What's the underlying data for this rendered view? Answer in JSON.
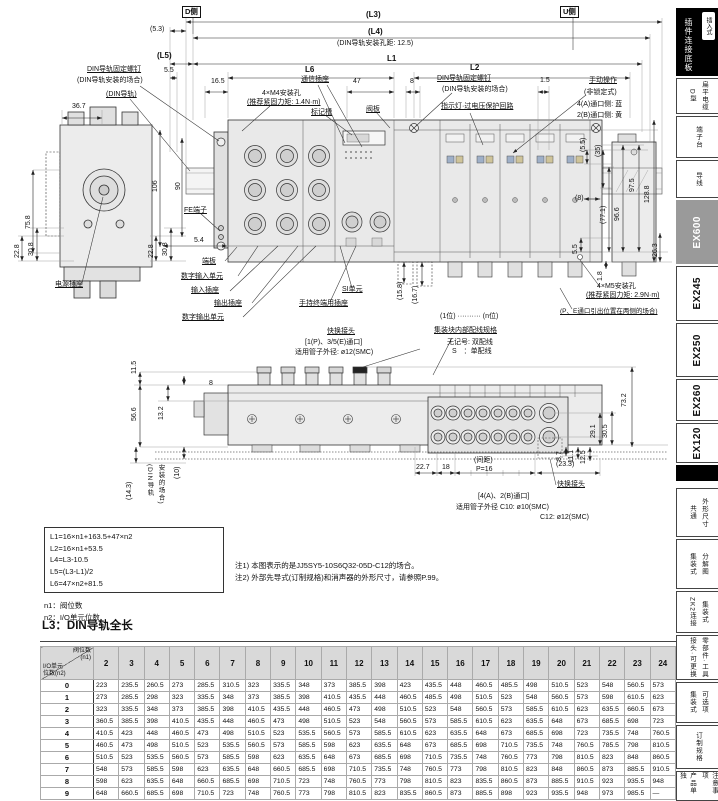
{
  "d1": {
    "side_d": "D侧",
    "side_u": "U侧",
    "l3": "(L3)",
    "dim53": "(5.3)",
    "l4": "(L4)",
    "din_pitch": "(DIN导轨安装孔距: 12.5)",
    "l5": "(L5)",
    "l1": "L1",
    "dim55": "5.5",
    "l6": "L6",
    "l2": "L2",
    "dim165": "16.5",
    "comm_socket": "通信插座",
    "dim47": "47",
    "dim8": "8",
    "dim15": "1.5",
    "m4_hole": "4×M4安装孔",
    "m4_torque": "(推荐紧固力矩: 1.4N·m)",
    "mark_slot": "标记槽",
    "din_screw": "DIN导轨固定螺钉",
    "din_screw_case": "(DIN导轨安装的场合)",
    "din_rail": "(DIN导轨)",
    "valve_plate": "阀板",
    "din_screw_r": "DIN导轨固定螺钉",
    "din_screw_r_case": "(DIN导轨安装的场合)",
    "indicator": "指示灯·过电压保护回路",
    "manual_op": "手动操作",
    "manual_type": "(非锁定式)",
    "manual_a": "4(A)通口侧: 蓝",
    "manual_b": "2(B)通口侧: 黄",
    "dim367": "36.7",
    "dim106": "106",
    "dim90": "90",
    "dim758": "75.8",
    "fe_terminal": "FE端子",
    "dim228a": "22.8",
    "dim308a": "30.8",
    "dim228b": "22.8",
    "dim308b": "30.8",
    "dim54": "5.4",
    "power_socket": "电源插座",
    "end_plate": "端板",
    "digital_in": "数字输入单元",
    "in_socket": "输入插座",
    "out_socket": "输出插座",
    "digital_out": "数字输出单元",
    "si_unit": "SI单元",
    "handheld": "手持终端用插座",
    "rdim55t": "(5.5)",
    "rdim35": "(35)",
    "rdim975": "97.5",
    "rdim1288": "128.8",
    "rdim8": "(8)",
    "rdim771": "(77.1)",
    "rdim966": "96.6",
    "rdim55b": "5.5",
    "rdim263": "26.3",
    "rdim18": "1.8",
    "dim158": "(15.8)",
    "dim167": "(16.7)",
    "m5_hole": "4×M5安装孔",
    "m5_torque": "(推荐紧固力矩: 2.9N·m)",
    "pe_note": "(P、E通口引出位置在两侧的场合)",
    "pos_range": "(1位) ·········· (n位)",
    "wiring_title": "集装块内部配线规格",
    "wiring_none": "无记号: 双配线",
    "wiring_s": "S　：单配线"
  },
  "d2": {
    "qf_top": "快换接头",
    "qf_top_ports": "[1(P)、3/5(E)通口]",
    "qf_top_tube": "适用管子外径: ø12(SMC)",
    "dim115": "11.5",
    "dim8": "8",
    "dim132": "13.2",
    "dim566": "56.6",
    "dim10": "(10)",
    "dim143": "(14.3)",
    "din_case1": "(DIN导轨",
    "din_case2": "安装的场合)",
    "dim732": "73.2",
    "dim305": "30.5",
    "dim291": "29.1",
    "dim87": "8.7",
    "dim111": "11.1",
    "dim125": "12.5",
    "dim227": "22.7",
    "dim18": "18",
    "pitch_label": "(间距)",
    "pitch_val": "P=16",
    "dim233": "(23.3)",
    "qf_bot": "快换接头",
    "qf_bot_ports": "[4(A)、2(B)通口]",
    "qf_bot_tube": "适用管子外径 C10: ø10(SMC)",
    "qf_bot_tube2": "C12: ø12(SMC)"
  },
  "formulas": [
    "L1=16×n1+163.5+47×n2",
    "L2=16×n1+53.5",
    "L4=L3-10.5",
    "L5=(L3-L1)/2",
    "L6=47×n2+81.5"
  ],
  "defs": [
    "n1：阀位数",
    "n2：I/O单元位数"
  ],
  "notes": [
    "注1) 本图表示的是JJ5SY5-10S6Q32-05D-C12的场合。",
    "注2) 外部先导式(订制规格)和消声器的外形尺寸，请参照P.99。"
  ],
  "table": {
    "title": "L3：DIN导轨全长",
    "corner_top": "阀位数",
    "corner_top2": "(n1)",
    "corner_left": "I/O单元",
    "corner_left2": "位数(n2)",
    "columns": [
      "2",
      "3",
      "4",
      "5",
      "6",
      "7",
      "8",
      "9",
      "10",
      "11",
      "12",
      "13",
      "14",
      "15",
      "16",
      "17",
      "18",
      "19",
      "20",
      "21",
      "22",
      "23",
      "24"
    ],
    "rows": [
      {
        "n2": "0",
        "values": [
          223,
          235.5,
          260.5,
          273,
          285.5,
          310.5,
          323,
          335.5,
          348,
          373,
          385.5,
          398,
          423,
          435.5,
          448,
          460.5,
          485.5,
          498,
          510.5,
          523,
          548,
          560.5,
          573
        ]
      },
      {
        "n2": "1",
        "values": [
          273,
          285.5,
          298,
          323,
          335.5,
          348,
          373,
          385.5,
          398,
          410.5,
          435.5,
          448,
          460.5,
          485.5,
          498,
          510.5,
          523,
          548,
          560.5,
          573,
          598,
          610.5,
          623
        ]
      },
      {
        "n2": "2",
        "values": [
          323,
          335.5,
          348,
          373,
          385.5,
          398,
          410.5,
          435.5,
          448,
          460.5,
          473,
          498,
          510.5,
          523,
          548,
          560.5,
          573,
          585.5,
          610.5,
          623,
          635.5,
          660.5,
          673
        ]
      },
      {
        "n2": "3",
        "values": [
          360.5,
          385.5,
          398,
          410.5,
          435.5,
          448,
          460.5,
          473,
          498,
          510.5,
          523,
          548,
          560.5,
          573,
          585.5,
          610.5,
          623,
          635.5,
          648,
          673,
          685.5,
          698,
          723
        ]
      },
      {
        "n2": "4",
        "values": [
          410.5,
          423,
          448,
          460.5,
          473,
          498,
          510.5,
          523,
          535.5,
          560.5,
          573,
          585.5,
          610.5,
          623,
          635.5,
          648,
          673,
          685.5,
          698,
          723,
          735.5,
          748,
          760.5
        ]
      },
      {
        "n2": "5",
        "values": [
          460.5,
          473,
          498,
          510.5,
          523,
          535.5,
          560.5,
          573,
          585.5,
          598,
          623,
          635.5,
          648,
          673,
          685.5,
          698,
          710.5,
          735.5,
          748,
          760.5,
          785.5,
          798,
          810.5
        ]
      },
      {
        "n2": "6",
        "values": [
          510.5,
          523,
          535.5,
          560.5,
          573,
          585.5,
          598,
          623,
          635.5,
          648,
          673,
          685.5,
          698,
          710.5,
          735.5,
          748,
          760.5,
          773,
          798,
          810.5,
          823,
          848,
          860.5
        ]
      },
      {
        "n2": "7",
        "values": [
          548,
          573,
          585.5,
          598,
          623,
          635.5,
          648,
          660.5,
          685.5,
          698,
          710.5,
          735.5,
          748,
          760.5,
          773,
          798,
          810.5,
          823,
          848,
          860.5,
          873,
          885.5,
          910.5
        ]
      },
      {
        "n2": "8",
        "values": [
          598,
          623,
          635.5,
          648,
          660.5,
          685.5,
          698,
          710.5,
          723,
          748,
          760.5,
          773,
          798,
          810.5,
          823,
          835.5,
          860.5,
          873,
          885.5,
          910.5,
          923,
          935.5,
          948
        ]
      },
      {
        "n2": "9",
        "values": [
          648,
          660.5,
          685.5,
          698,
          710.5,
          723,
          748,
          760.5,
          773,
          798,
          810.5,
          823,
          835.5,
          860.5,
          873,
          885.5,
          898,
          923,
          935.5,
          948,
          973,
          985.5,
          "—"
        ]
      }
    ]
  },
  "sidebar": {
    "badge": "插入式",
    "top_tab": "插件连接底板",
    "tabs": [
      {
        "primary": "扁平电缆",
        "secondary": "D型"
      },
      {
        "primary": "端子台",
        "secondary": ""
      },
      {
        "primary": "导线",
        "secondary": ""
      }
    ],
    "series": [
      {
        "label": "EX600"
      },
      {
        "label": "EX245"
      },
      {
        "label": "EX250"
      },
      {
        "label": "EX260"
      },
      {
        "label": "EX120"
      }
    ],
    "bottom_tabs": [
      {
        "primary": "外形尺寸",
        "secondary": "共通"
      },
      {
        "primary": "分解图",
        "secondary": "集装式"
      },
      {
        "primary": "集装式",
        "secondary": "ZK2连接"
      },
      {
        "primary": "零部件·工具",
        "secondary": "接头·可更换"
      },
      {
        "primary": "可选项",
        "secondary": "集装式"
      },
      {
        "primary": "订制规格",
        "secondary": ""
      },
      {
        "primary": "注意事项",
        "secondary": "产品单独"
      }
    ]
  }
}
